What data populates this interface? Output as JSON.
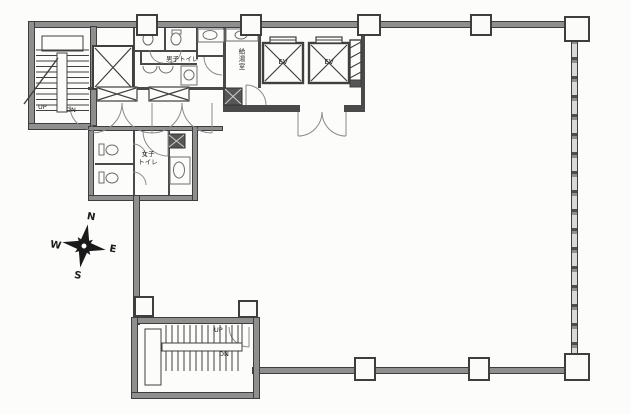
{
  "title": "office-floor-plan",
  "colors": {
    "background": "#fcfcfa",
    "exterior_wall": "#8f8f8f",
    "wall_outline": "#3e3e3e",
    "partition": "#4a4a4a",
    "dark_shaft": "#555555",
    "door_arc": "#8a8a8a",
    "compass_ink": "#1a1a1a"
  },
  "labels": {
    "upper_stair": {
      "up": "UP",
      "dn": "DN"
    },
    "lower_stair": {
      "up": "UP",
      "dn": "DN"
    },
    "elevators": [
      {
        "label": "EV"
      },
      {
        "label": "EV"
      }
    ],
    "rooms": {
      "mens_toilet": "男子トイレ",
      "womens_toilet_line1": "女子",
      "womens_toilet_line2": "トイレ",
      "kitchenette": "給湯室"
    },
    "compass": {
      "n": "N",
      "e": "E",
      "s": "S",
      "w": "W"
    }
  }
}
